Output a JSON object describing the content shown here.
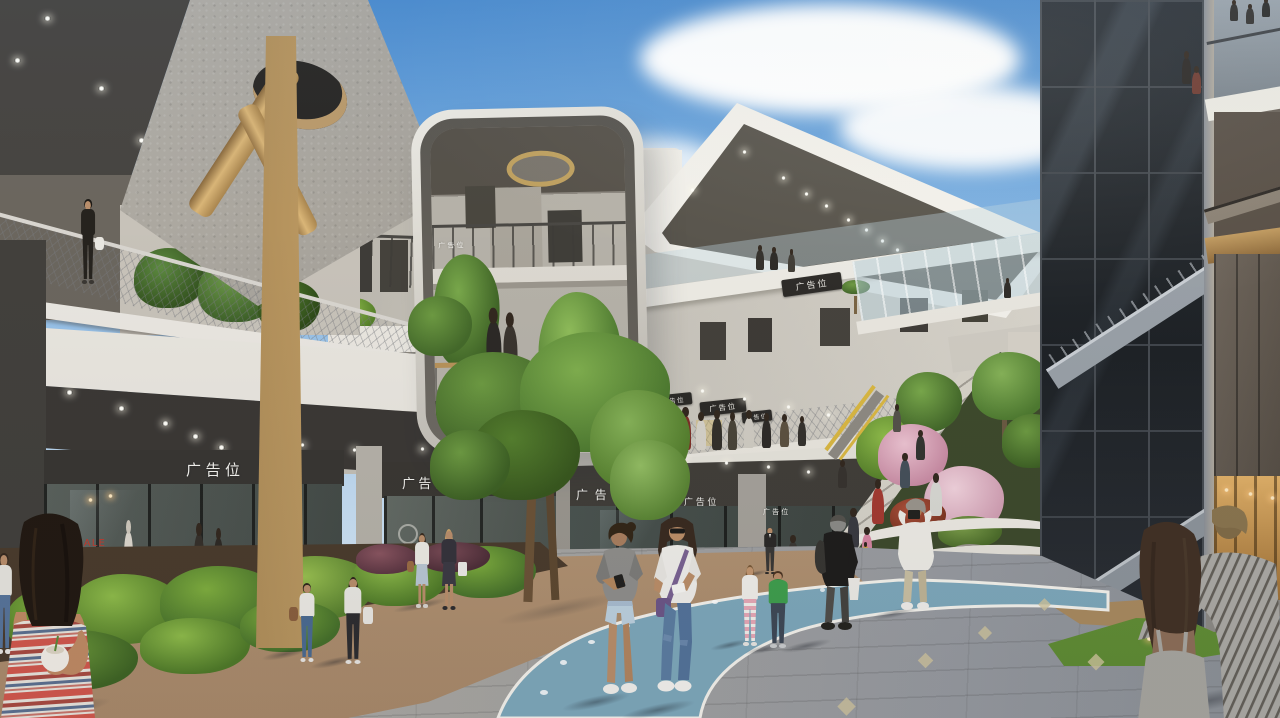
{
  "scene": {
    "signs": {
      "ad": "广告位",
      "sale": "SALE"
    },
    "palette": {
      "sky": "#4c8cce",
      "concrete_light": "#e9e6df",
      "soffit_dark": "#3b3835",
      "wood_column": "#c9a469",
      "glass_tower": "#23272c",
      "path_blue": "#7ea8bb",
      "paving_tan": "#b79c7f",
      "paving_grey": "#a3a19d",
      "foliage_green": "#6d9a42",
      "blossom_pink": "#ecc3d1",
      "accent_yellow": "#d9b742",
      "sale_red": "#c23b2e"
    }
  }
}
